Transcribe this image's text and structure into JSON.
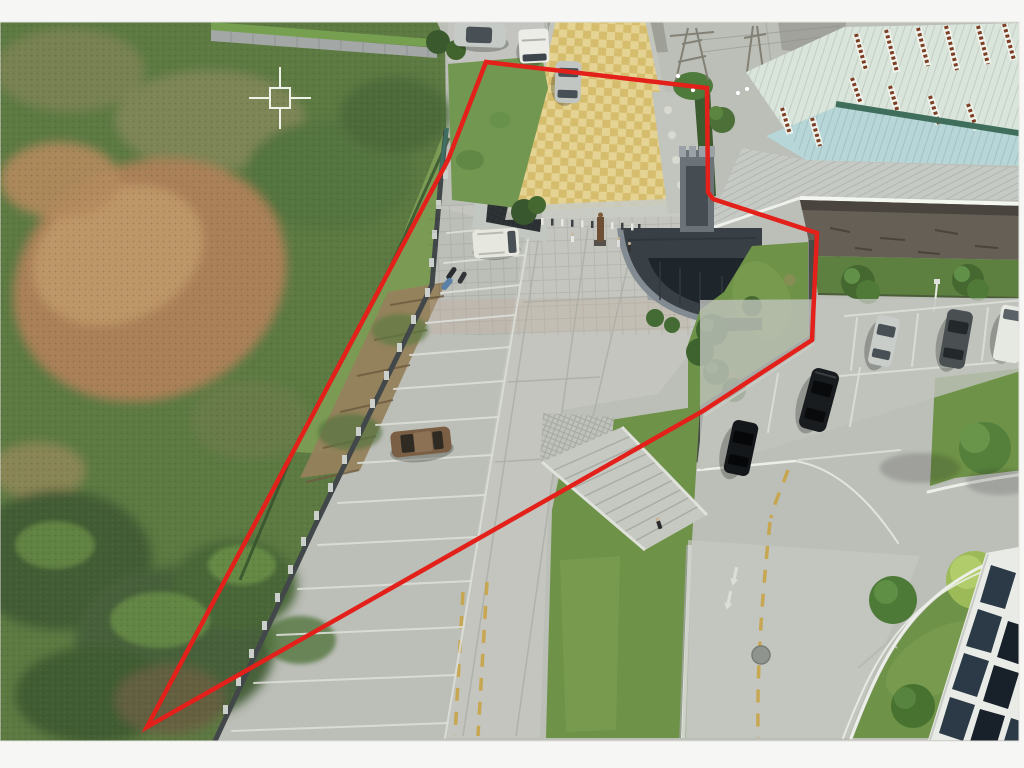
{
  "canvas": {
    "width": 1024,
    "height": 768,
    "margin_color": "#f6f6f4"
  },
  "photo": {
    "left": 0,
    "top": 22,
    "width": 1019,
    "height": 719,
    "subject": "aerial drone view of a factory entrance gate, concrete parking lots, access road and a fenced vacant green lot"
  },
  "boundary": {
    "points": "486,62 707,88 708,192 713,199 817,233 812,340 703,411 147,727 448,160",
    "color": "#e3201a",
    "stroke_width": 4.5
  },
  "crosshair": {
    "x": 280,
    "y": 98,
    "transform": "translate(280,98)",
    "color": "#edf3e6",
    "pickbox_size": 20,
    "arm_length": 31,
    "gap": 10
  },
  "palette": {
    "concrete": "#bcbeb8",
    "concrete_light": "#c6c8c2",
    "asphalt": "#9a9c94",
    "lot_green": "#5d7a43",
    "lot_green_dark": "#435c35",
    "dirt": "#ab8058",
    "dirt_light": "#c29a6a",
    "terrace_tan": "#95815c",
    "mow_strip": "#7b9b55",
    "bank_grass": "#729750",
    "lawn": "#6e9247",
    "verge_green": "#5d8040",
    "ramp_yellow_a": "#d6bd6d",
    "ramp_yellow_b": "#e4d392",
    "plaza": "#b9bcb5",
    "gatehouse_dark": "#383f45",
    "tower_gray": "#6b7379",
    "roof_pale": "#d9e4da",
    "roof_blue": "#b7d6d8",
    "ridge_teal": "#3f6f5c",
    "awning_gray": "#c6cac5",
    "fascia_white": "#f4f6f0",
    "stone_wall": "#655f55",
    "facade_white": "#e9ebe7",
    "window_a": "#2c3a47",
    "window_b": "#182029",
    "wall_pillar": "#ccd0ca",
    "wall_panel": "#42474a"
  },
  "scene": {
    "vehicles": [
      {
        "name": "suv-silver-top",
        "color": "#c6cac7"
      },
      {
        "name": "minibus-white-top",
        "color": "#ecede7"
      },
      {
        "name": "sedan-gray-ramp",
        "color": "#c2c6c2"
      },
      {
        "name": "van-white-parking",
        "color": "#e6e8e0"
      },
      {
        "name": "car-brown",
        "color": "#7a5f45"
      },
      {
        "name": "car-silver-right",
        "color": "#c9cdc9"
      },
      {
        "name": "car-darkgray-right",
        "color": "#4a5052"
      },
      {
        "name": "van-white-right",
        "color": "#e6e8e2"
      },
      {
        "name": "sedan-black",
        "color": "#191c1e"
      },
      {
        "name": "suv-black",
        "color": "#141719"
      },
      {
        "name": "motorbike-blue",
        "color": "#5b80a8"
      }
    ],
    "people_count": 4,
    "birds_count": 4
  }
}
